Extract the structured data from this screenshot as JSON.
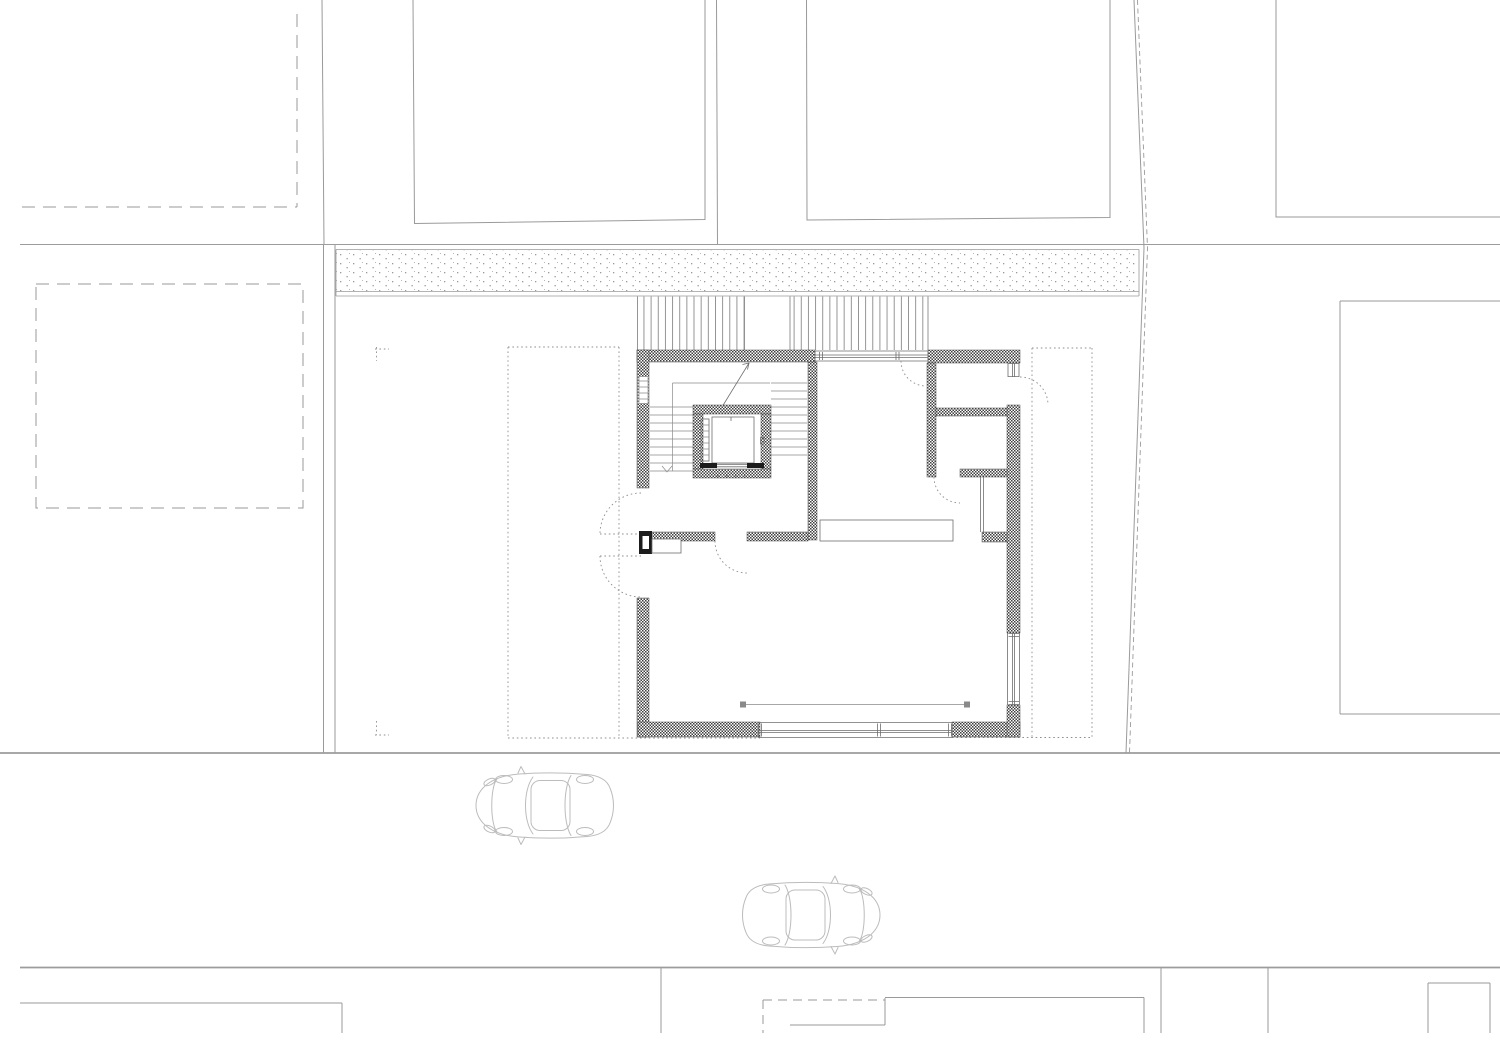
{
  "meta": {
    "title": "Architectural site plan — ground floor with street and context parcels",
    "drawing_type": "floor-plan",
    "visible_text": "none"
  },
  "canvas": {
    "width": 1500,
    "height": 1060,
    "background": "#ffffff"
  },
  "colors": {
    "context_line": "#9a9a9a",
    "street_line": "#9c9c9c",
    "wall_hatch": "#3f3f3f",
    "wall_outline": "#4a4a4a",
    "thin_line": "#6e6e6e",
    "stair_line": "#8a8a8a",
    "dotted_line": "#8f8f8f",
    "stipple_dot": "#9a9a9a",
    "ramp_line": "#8a8a8a",
    "car_line": "#bcbcbc",
    "door_black": "#1c1c1c"
  },
  "site": {
    "neighbor_buildings_top": 4,
    "dashed_parcel_outlines": 3,
    "sidewalk_texture": "stipple dots",
    "outdoor_stair_flights": 2,
    "terrace_outlines_dotted": 2,
    "corner_markers_dotted": 2
  },
  "building": {
    "rooms": [
      "stair-hall",
      "entry",
      "living-dining",
      "kitchen",
      "room-ne-upper",
      "room-ne-lower",
      "closet-shaft"
    ],
    "elevator": {
      "present": true,
      "cabin": true,
      "landing_door": true
    },
    "stair": {
      "flights": 2,
      "direction_arrow": true
    },
    "exterior_doors": 4,
    "interior_doors": 2,
    "window_bands": [
      "top",
      "bottom",
      "east-lower",
      "east-upper"
    ],
    "furniture": [
      "kitchen-counter",
      "entry-cabinet"
    ]
  },
  "street": {
    "cars": [
      {
        "id": "car-1",
        "facing": "left"
      },
      {
        "id": "car-2",
        "facing": "right"
      }
    ]
  }
}
